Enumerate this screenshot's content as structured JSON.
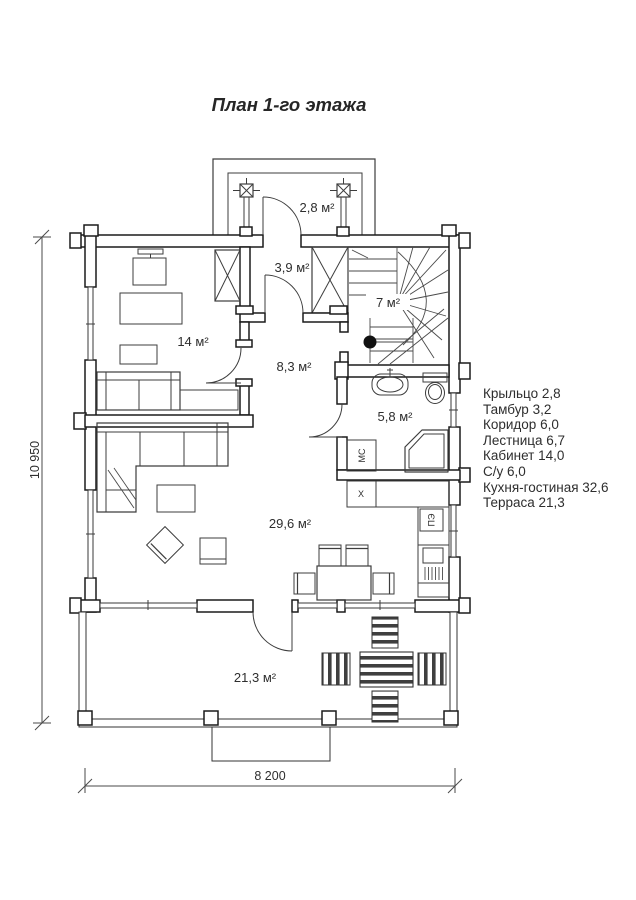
{
  "title": "План 1-го этажа",
  "rooms": {
    "porch": {
      "name": "Крыльцо",
      "area_label": "2,8 м²"
    },
    "tambour": {
      "name": "Тамбур",
      "area_label": "3,9 м²"
    },
    "stairs": {
      "name": "Лестница",
      "area_label": "7 м²"
    },
    "study": {
      "name": "Кабинет",
      "area_label": "14 м²"
    },
    "corridor": {
      "name": "Коридор",
      "area_label": "8,3 м²"
    },
    "bathroom": {
      "name": "С/у",
      "area_label": "5,8 м²"
    },
    "kitchen_living": {
      "name": "Кухня-гостиная",
      "area_label": "29,6 м²"
    },
    "terrace": {
      "name": "Терраса",
      "area_label": "21,3 м²"
    }
  },
  "appliances": {
    "washing_machine": "МС",
    "fridge": "Х",
    "stove": "ПЭ"
  },
  "dimensions": {
    "height": "10 950",
    "width": "8 200"
  },
  "legend": {
    "items": [
      "Крыльцо 2,8",
      "Тамбур 3,2",
      "Коридор 6,0",
      "Лестница 6,7",
      "Кабинет 14,0",
      "С/у 6,0",
      "Кухня-гостиная 32,6",
      "Терраса 21,3"
    ]
  },
  "colors": {
    "line": "#1b1b1b",
    "furniture": "#3d3d3d",
    "text": "#2e2e2e",
    "background": "#ffffff"
  }
}
